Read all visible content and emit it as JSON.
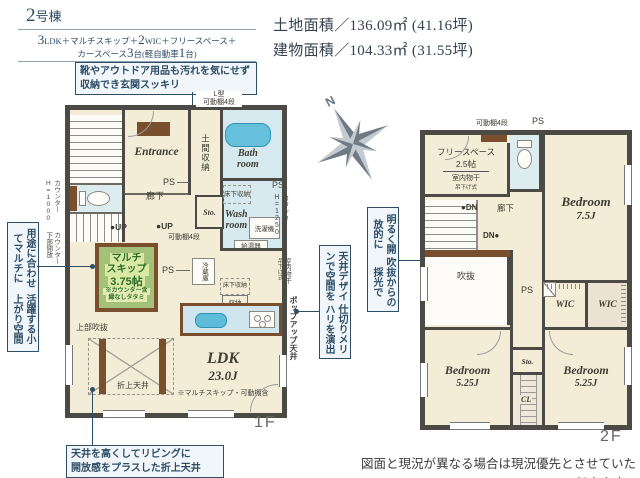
{
  "header": {
    "building_num": "2",
    "building_suffix": "号棟",
    "l1_n1": "3",
    "l1_t1": "LDK＋マルチスキップ＋",
    "l1_n2": "2",
    "l1_t2": "WIC＋フリースペース＋",
    "l2_t1": "カースペース",
    "l2_n1": "3",
    "l2_t2": "台(軽自動車",
    "l2_n2": "1",
    "l2_t3": "台)"
  },
  "areas": {
    "land": "土地面積／136.09㎡ (41.16坪)",
    "building": "建物面積／104.33㎡ (31.55坪)"
  },
  "callouts": {
    "entrance_l1": "靴やアウトドア用品も汚れを気にせず",
    "entrance_l2": "収納でき玄関スッキリ",
    "multi_c1": "用途に合わせてマルチに",
    "multi_c2": "活躍する小上がり空間",
    "daylight_c1": "明るく開放的に",
    "daylight_c2": "吹抜からの採光で",
    "ceiling_c1": "天井デザインで空間を",
    "ceiling_c2": "仕切りメリハリを演出",
    "coffered_l1": "天井を高くしてリビングに",
    "coffered_l2": "開放感をプラスした折上天井"
  },
  "compass": {
    "north": "N"
  },
  "floor1": {
    "label": "1F",
    "entrance": "Entrance",
    "doma": "土間収納",
    "bath1": "Bath",
    "bath2": "room",
    "wash1": "Wash",
    "wash2": "room",
    "hallway": "廊下",
    "sto": "Sto.",
    "ps1": "PS",
    "ps2": "PS",
    "up1": "●UP",
    "up2": "●UP",
    "l_shelf1": "L型",
    "l_shelf2": "可動棚4段",
    "shelf": "可動棚4段",
    "yukashita": "床下収納",
    "yukashita2": "床下収納",
    "shuno": "収納",
    "washer": "洗濯機",
    "boiler": "給湯器",
    "fridge": "冷蔵庫",
    "multi1": "マルチ",
    "multi2": "スキップ",
    "multi3": "3.75帖",
    "multi_note1": "※カウンター含",
    "multi_note2": "縁なしタタミ",
    "joubu": "上部吹抜",
    "oriage": "折上天井",
    "ldk": "LDK",
    "ldk_size": "23.0J",
    "ldk_note": "※マルチスキップ・可動棚含",
    "counter_r1": "カウンター",
    "counter_r2": "H=1250",
    "monohoshi1": "室内物干",
    "monohoshi2": "吊下げ式",
    "popup": "ポップアップ天井",
    "counter_a1": "カウンター",
    "counter_a2": "H=1000",
    "counter_b1": "カウンター",
    "counter_b2": "下部開放"
  },
  "floor2": {
    "label": "2F",
    "free1": "フリースペース",
    "free2": "2.5帖",
    "free3": "室内物干",
    "free4": "吊下げ式",
    "shelf": "可動棚4段",
    "ps_top": "PS",
    "ps": "PS",
    "bed1": "Bedroom",
    "bed1_size": "7.5J",
    "bed2": "Bedroom",
    "bed2_size": "5.25J",
    "bed3": "Bedroom",
    "bed3_size": "5.25J",
    "wic1": "WIC",
    "wic2": "WIC",
    "cl": "CL",
    "sto": "Sto.",
    "void": "吹抜",
    "hallway": "廊下",
    "dn1": "●DN",
    "dn2": "DN●"
  },
  "footer": {
    "disclaimer": "図面と現況が異なる場合は現況優先とさせていただきます。"
  }
}
